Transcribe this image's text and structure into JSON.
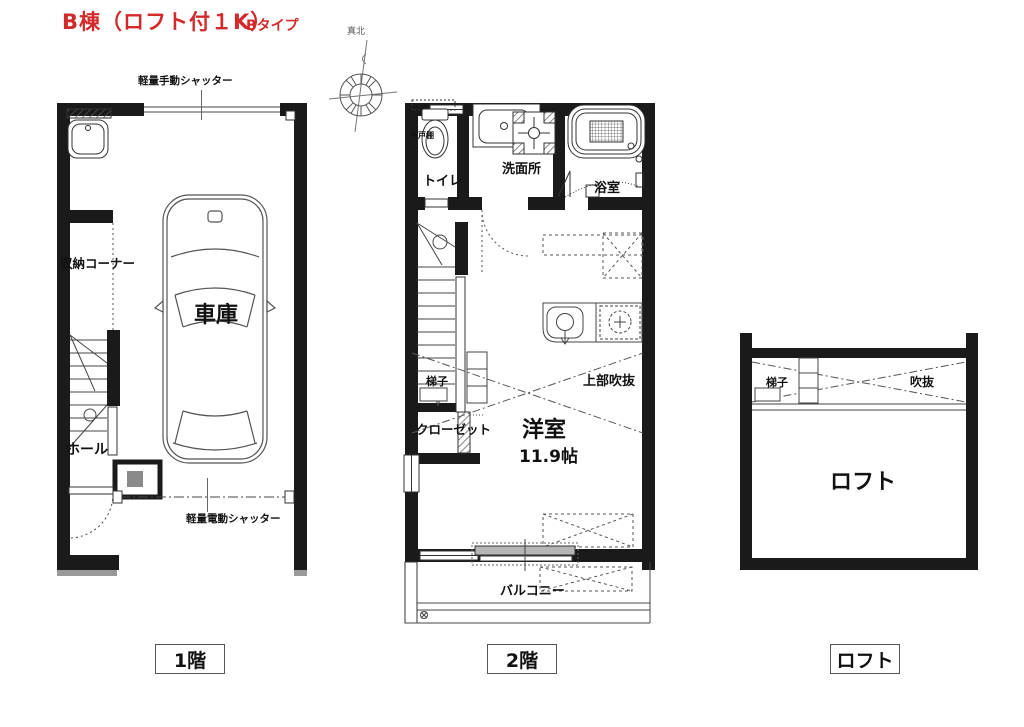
{
  "title": {
    "main": "B棟（ロフト付１K）",
    "sub": "Bタイプ"
  },
  "compass": {
    "north_label": "真北"
  },
  "floor1": {
    "tag": "1階",
    "shutter_top": "軽量手動シャッター",
    "shutter_bottom": "軽量電動シャッター",
    "storage_corner": "収納コーナー",
    "garage": "車庫",
    "hall": "ホール"
  },
  "floor2": {
    "tag": "2階",
    "hanging_cupboard": "吊戸棚",
    "toilet": "トイレ",
    "washroom": "洗面所",
    "bathroom": "浴室",
    "ladder": "梯子",
    "upper_void": "上部吹抜",
    "closet": "クローゼット",
    "western_room": "洋室",
    "room_size": "11.9帖",
    "balcony": "バルコニー"
  },
  "loft": {
    "tag": "ロフト",
    "ladder": "梯子",
    "void": "吹抜",
    "name": "ロフト"
  },
  "colors": {
    "wall": "#1a1a1a",
    "accent_red": "#d22a2a",
    "line": "#444",
    "gray_fill": "#b0b0b0"
  }
}
